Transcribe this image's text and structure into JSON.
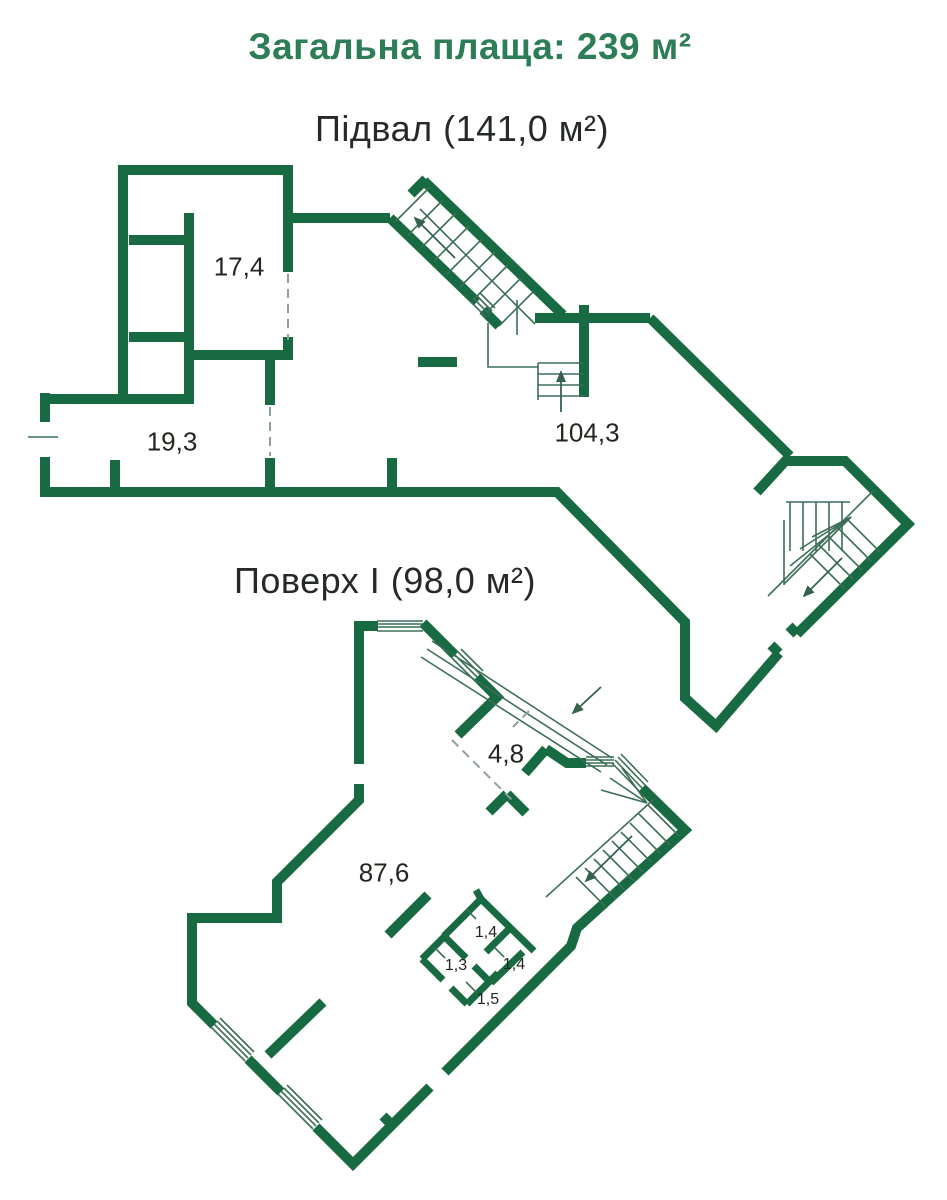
{
  "page_title": "Загальна плаща: 239 м²",
  "floors": [
    {
      "id": "basement",
      "title": "Підвал (141,0 м²)",
      "rooms": [
        {
          "area": "17,4"
        },
        {
          "area": "19,3"
        },
        {
          "area": "104,3"
        }
      ]
    },
    {
      "id": "floor1",
      "title": "Поверх I (98,0 м²)",
      "rooms": [
        {
          "area": "4,8"
        },
        {
          "area": "87,6"
        },
        {
          "area": "1,4"
        },
        {
          "area": "1,3"
        },
        {
          "area": "1,4"
        },
        {
          "area": "1,5"
        }
      ]
    }
  ],
  "colors": {
    "wall_green": "#176a41",
    "title_green": "#2d7d56",
    "text_dark": "#23261f",
    "thin_line": "#3c6e58",
    "dash_gray": "#8fa096"
  }
}
